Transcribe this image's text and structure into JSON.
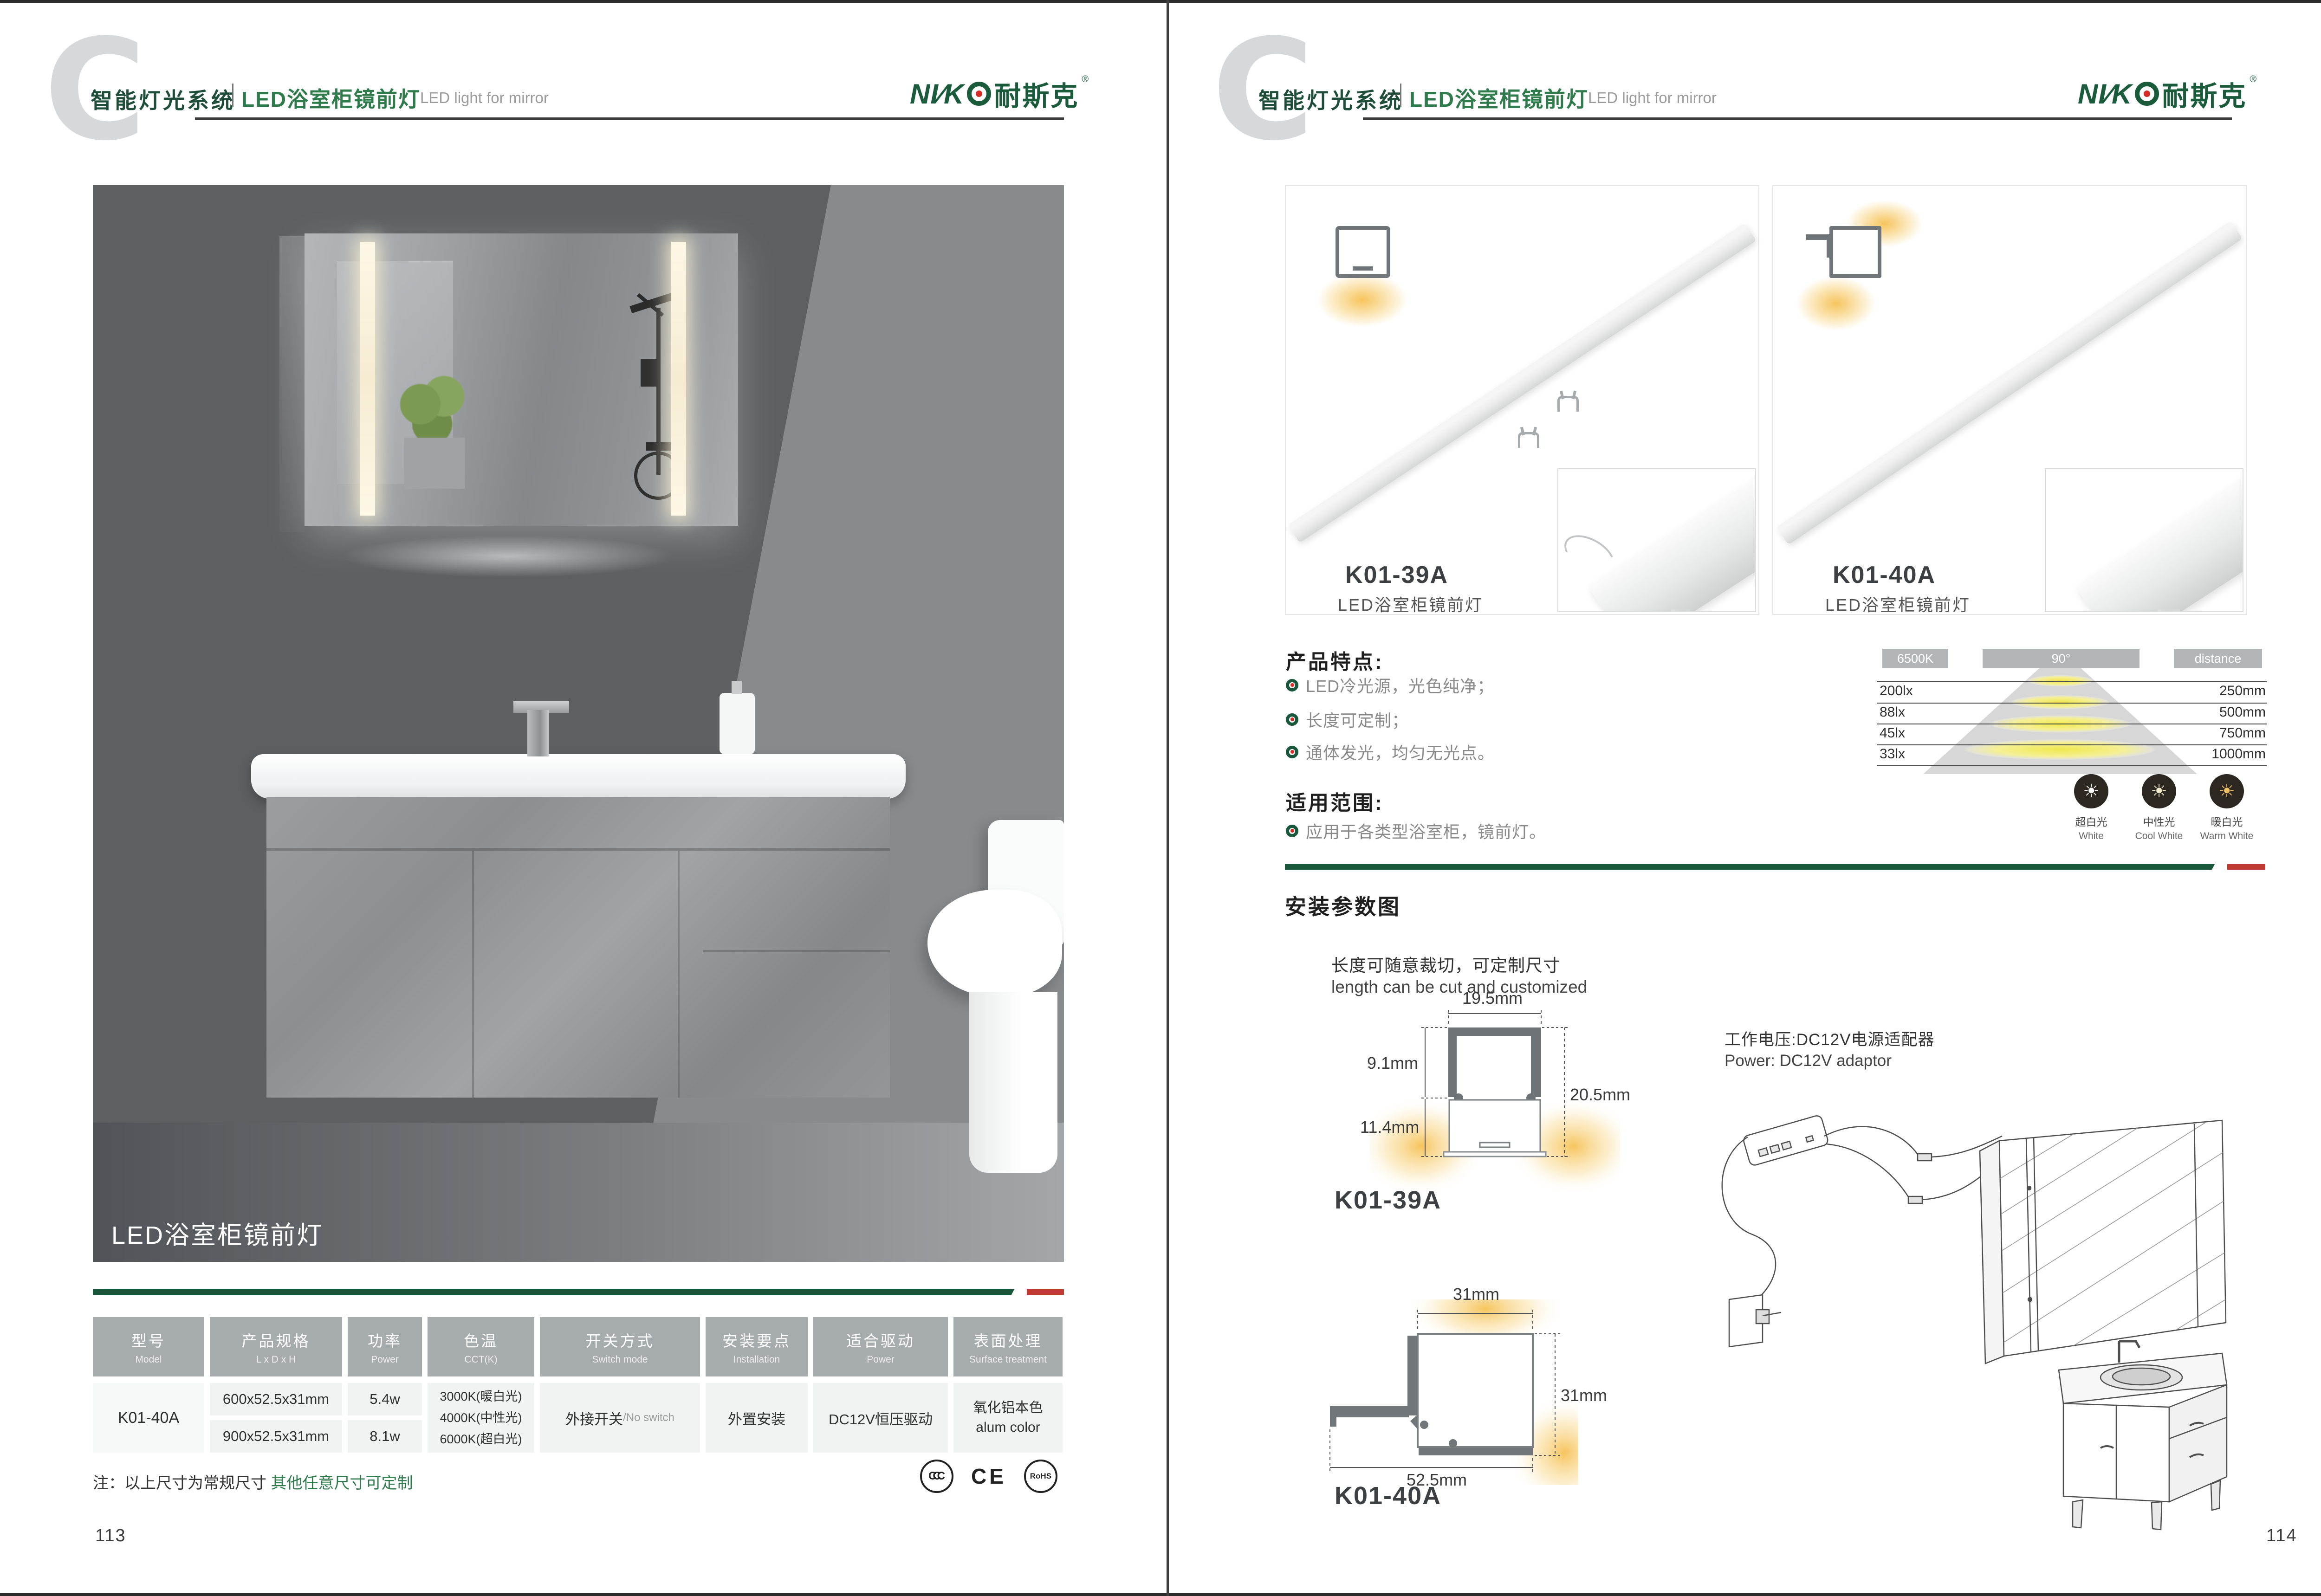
{
  "brand": {
    "title_cn": "智能灯光系统",
    "subtitle_cn": "LED浴室柜镜前灯",
    "subtitle_en": "LED light for mirror",
    "logo_prefix": "NI∕K",
    "logo_cn": "耐斯克",
    "logo_reg": "®"
  },
  "colors": {
    "brand_green": "#1a5b3c",
    "accent_red": "#bf3a31",
    "table_header_gray": "#a6abad"
  },
  "left_page": {
    "hero_caption": "LED浴室柜镜前灯",
    "table": {
      "columns": [
        {
          "cn": "型号",
          "en": "Model"
        },
        {
          "cn": "产品规格",
          "en": "L x D x H"
        },
        {
          "cn": "功率",
          "en": "Power"
        },
        {
          "cn": "色温",
          "en": "CCT(K)"
        },
        {
          "cn": "开关方式",
          "en": "Switch mode"
        },
        {
          "cn": "安装要点",
          "en": "Installation"
        },
        {
          "cn": "适合驱动",
          "en": "Power"
        },
        {
          "cn": "表面处理",
          "en": "Surface treatment"
        }
      ],
      "row": {
        "model": "K01-40A",
        "sizes": [
          "600x52.5x31mm",
          "900x52.5x31mm"
        ],
        "powers": [
          "5.4w",
          "8.1w"
        ],
        "cct": [
          "3000K(暖白光)",
          "4000K(中性光)",
          "6000K(超白光)"
        ],
        "switch_cn": "外接开关",
        "switch_en": "/No switch",
        "installation": "外置安装",
        "driver": "DC12V恒压驱动",
        "surface_cn": "氧化铝本色",
        "surface_en": "alum color"
      }
    },
    "note_black": "注：以上尺寸为常规尺寸 ",
    "note_green": "其他任意尺寸可定制",
    "certs": {
      "ccc": "CCC",
      "ce": "CE",
      "rohs": "RoHS"
    },
    "page_number": "113"
  },
  "right_page": {
    "products": [
      {
        "model": "K01-39A",
        "name": "LED浴室柜镜前灯"
      },
      {
        "model": "K01-40A",
        "name": "LED浴室柜镜前灯"
      }
    ],
    "features": {
      "title": "产品特点:",
      "items": [
        "LED冷光源，光色纯净；",
        "长度可定制；",
        "通体发光，均匀无光点。"
      ]
    },
    "scope": {
      "title": "适用范围:",
      "items": [
        "应用于各类型浴室柜，镜前灯。"
      ]
    },
    "photometry": {
      "cct": "6500K",
      "beam": "90°",
      "distance_label": "distance",
      "rows": [
        {
          "lux": "200lx",
          "distance": "250mm"
        },
        {
          "lux": "88lx",
          "distance": "500mm"
        },
        {
          "lux": "45lx",
          "distance": "750mm"
        },
        {
          "lux": "33lx",
          "distance": "1000mm"
        }
      ]
    },
    "color_temps": [
      {
        "cn": "超白光",
        "en": "White"
      },
      {
        "cn": "中性光",
        "en": "Cool White"
      },
      {
        "cn": "暖白光",
        "en": "Warm White"
      }
    ],
    "icons": {
      "sun_glyph": "☀"
    },
    "install": {
      "title": "安装参数图",
      "cut_cn": "长度可随意裁切，可定制尺寸",
      "cut_en": "length can be cut and customized",
      "power_cn": "工作电压:DC12V电源适配器",
      "power_en": "Power: DC12V adaptor",
      "diagram1": {
        "model": "K01-39A",
        "top": "19.5mm",
        "left_upper": "9.1mm",
        "left_lower": "11.4mm",
        "right": "20.5mm"
      },
      "diagram2": {
        "model": "K01-40A",
        "top": "31mm",
        "right": "31mm",
        "bottom": "52.5mm"
      }
    },
    "page_number": "114"
  }
}
